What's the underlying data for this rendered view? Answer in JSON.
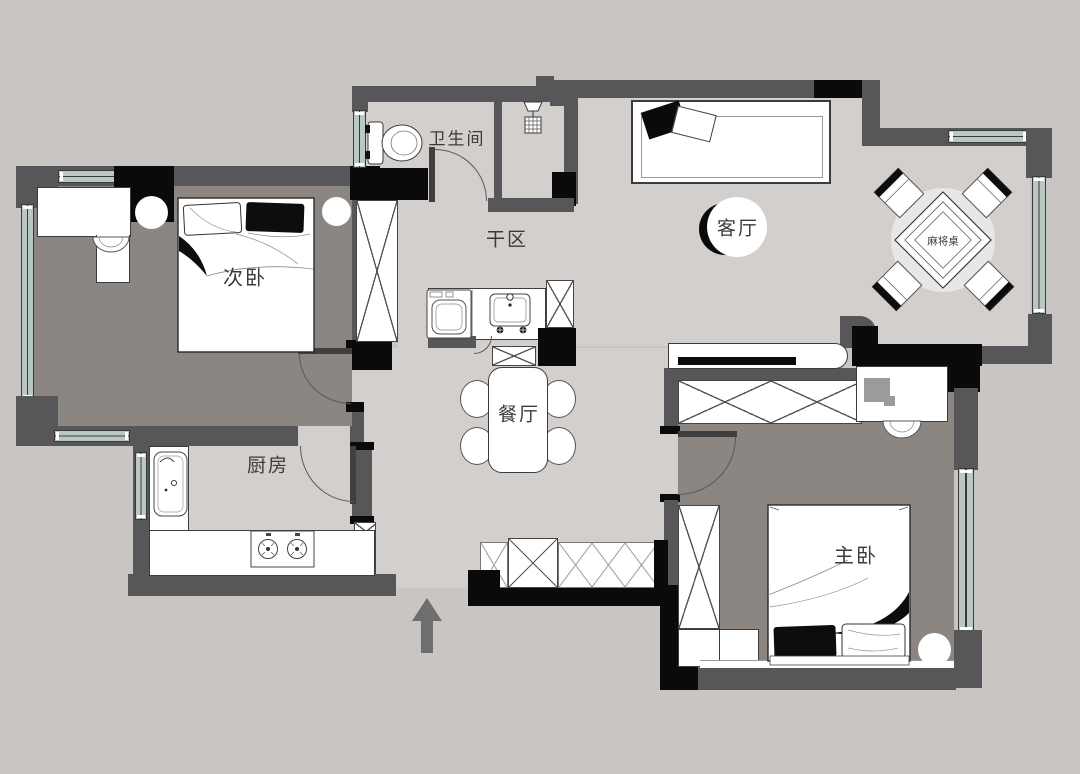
{
  "plan": {
    "labels": {
      "bathroom": "卫生间",
      "dry_area": "干区",
      "secondary_bedroom": "次卧",
      "kitchen": "厨房",
      "dining_room": "餐厅",
      "living_room": "客厅",
      "master_bedroom": "主卧",
      "mahjong_table": "麻将桌"
    },
    "colors": {
      "background": "#c9c5c2",
      "floor_light": "#d3cfcc",
      "floor_dark": "#8b8681",
      "wall_gray": "#57575a",
      "wall_black": "#0a0a0a",
      "window_glass": "#b9c8c3",
      "north_arrow": "#6e6e6e",
      "label_text": "#3b3b3b"
    },
    "icons": [
      "north-arrow",
      "toilet",
      "shower-head",
      "floor-drain",
      "washing-machine",
      "washbasin",
      "kitchen-sink",
      "gas-stove",
      "double-bed",
      "sofa",
      "tv-console",
      "dining-table",
      "mahjong-table",
      "wardrobe",
      "desk-chair"
    ]
  }
}
